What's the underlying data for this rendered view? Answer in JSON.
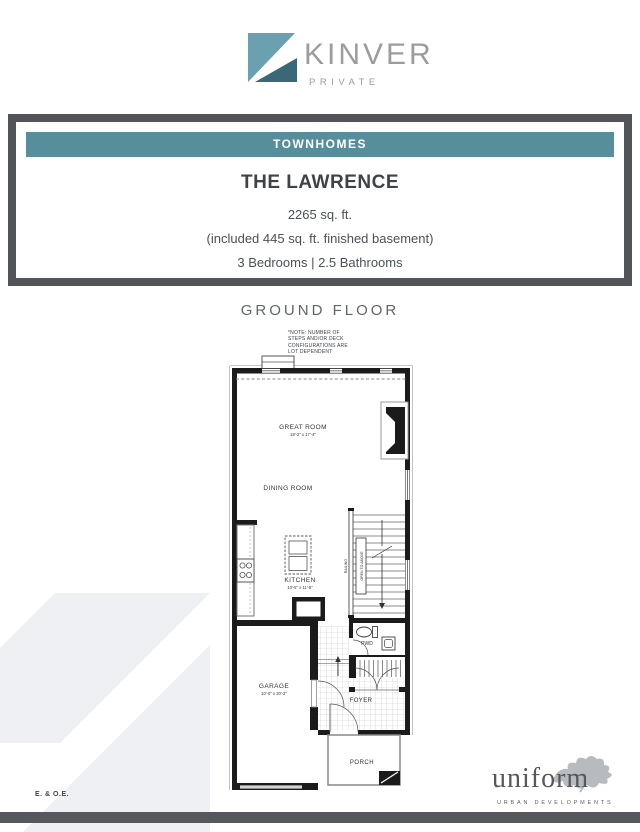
{
  "brand": {
    "name": "KINVER",
    "tagline": "PRIVATE",
    "logo_light_color": "#6AA0AF",
    "logo_dark_color": "#3A6877"
  },
  "card": {
    "banner": "TOWNHOMES",
    "banner_color": "#578E9B",
    "frame_color": "#515458",
    "title": "THE LAWRENCE",
    "sqft": "2265 sq. ft.",
    "basement_note": "(included 445 sq. ft. finished basement)",
    "beds_baths": "3 Bedrooms  |  2.5 Bathrooms"
  },
  "plan": {
    "heading": "GROUND FLOOR",
    "note": "*NOTE: NUMBER OF\nSTEPS AND/OR DECK\nCONFIGURATIONS ARE\nLOT DEPENDENT",
    "rooms": {
      "great_room": {
        "label": "GREAT ROOM",
        "dims": "19'-2\" x 17'-4\""
      },
      "dining_room": {
        "label": "DINING ROOM"
      },
      "kitchen": {
        "label": "KITCHEN",
        "dims": "10'-5\" x 11'-6\""
      },
      "garage": {
        "label": "GARAGE",
        "dims": "10'-0\" x 20'-2\""
      },
      "foyer": {
        "label": "FOYER"
      },
      "porch": {
        "label": "PORCH"
      },
      "pwd": {
        "label": "PWD"
      }
    },
    "annotations": {
      "open_to_above": "OPEN TO ABOVE",
      "railing": "RAILING"
    }
  },
  "footer": {
    "eoe": "E. & O.E.",
    "developer": "uniform",
    "developer_sub": "URBAN DEVELOPMENTS",
    "bar_color": "#55585C",
    "watermark_color": "#eef0f3"
  }
}
